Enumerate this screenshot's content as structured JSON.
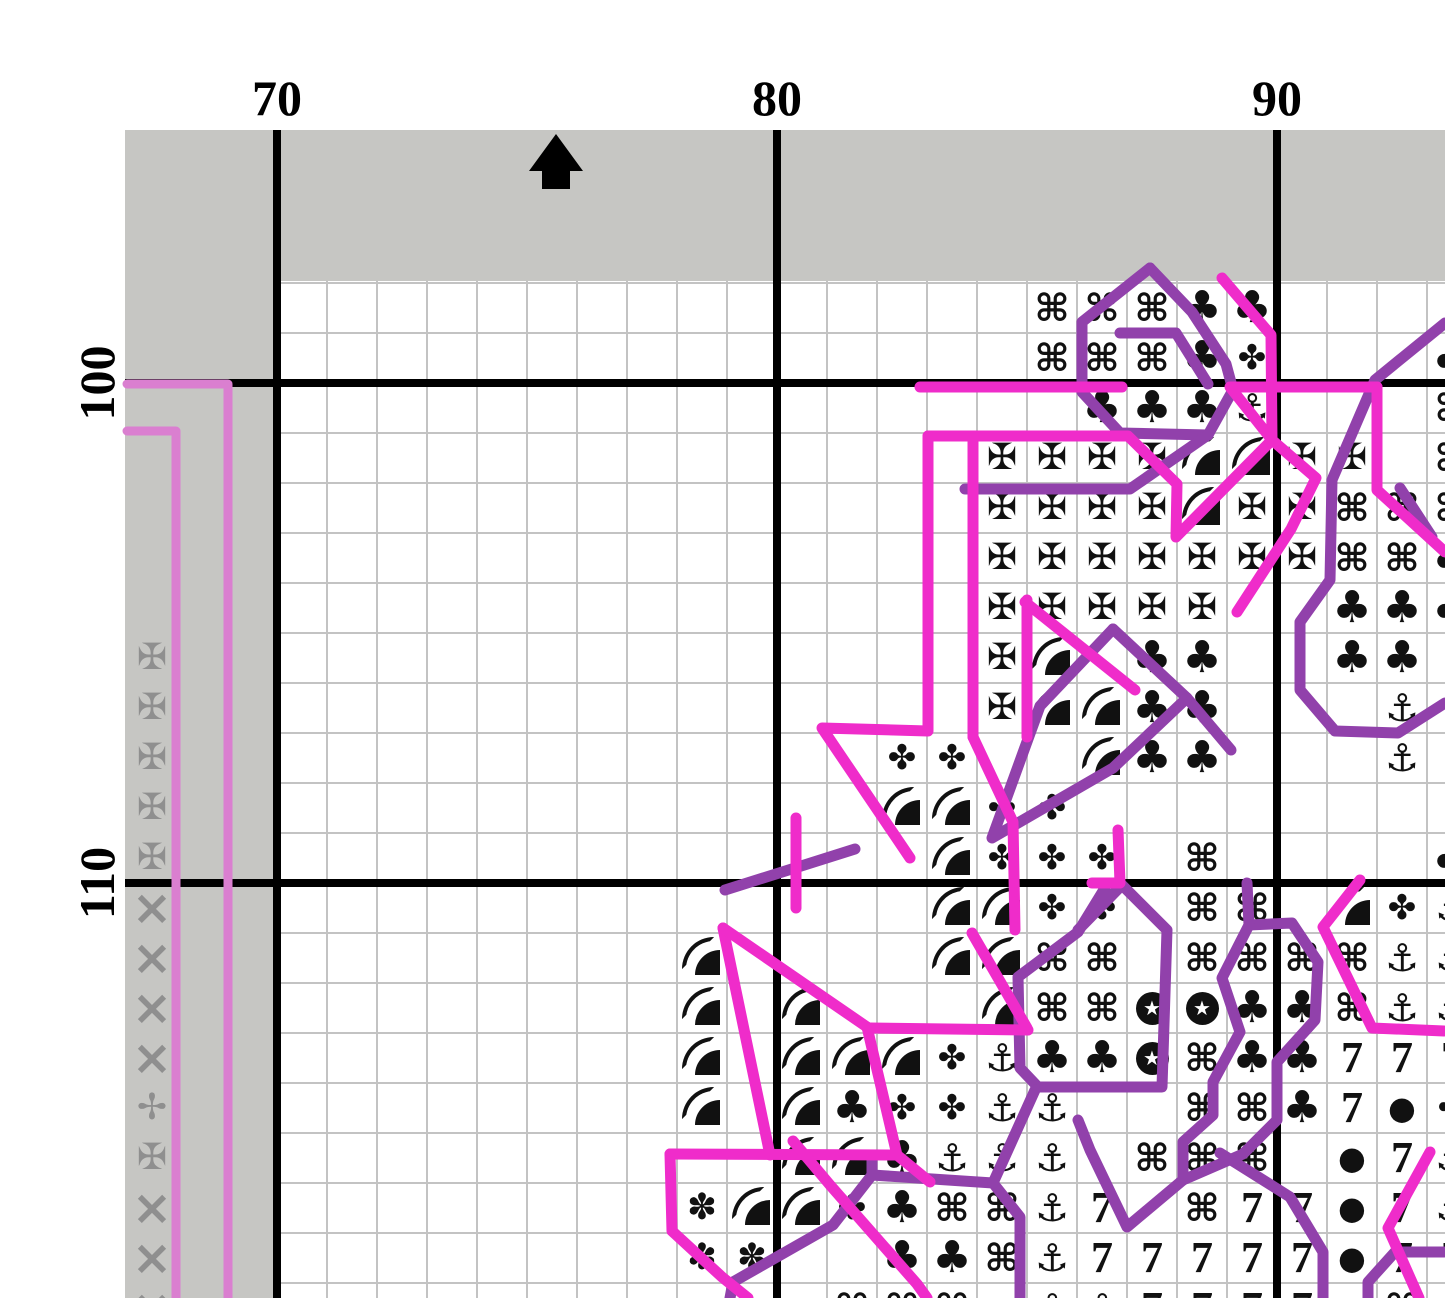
{
  "page": {
    "title": "cross-stitch-pattern-page",
    "colors": {
      "magenta_backstitch": "#ef2cca",
      "purple_backstitch": "#9141ab",
      "orchid_pageline": "#da7fd0",
      "margin_gray": "#c6c6c3",
      "minor_grid": "#c3c3c3",
      "major_grid": "#000000",
      "symbol_black": "#111111",
      "symbol_gray": "#8f8f8f",
      "paper": "#ffffff"
    }
  },
  "rulers": {
    "col_labels": [
      {
        "text": "70",
        "x": 277
      },
      {
        "text": "80",
        "x": 777
      },
      {
        "text": "90",
        "x": 1277
      }
    ],
    "row_labels": [
      {
        "text": "100",
        "y": 383
      },
      {
        "text": "110",
        "y": 883
      }
    ]
  },
  "center_arrow": {
    "tip_x": 556,
    "tip_y": 134
  },
  "legend": {
    "cmd": "⌘",
    "cross": "✠",
    "club": "♣",
    "flower": "✤",
    "anchor": "⚓",
    "seven": "7",
    "dot": "●",
    "x": "×",
    "thincross": "✢",
    "dotflower": "✽",
    "quarter": "(shape: quarter disc with arc)",
    "starcircle": "(shape: white star in black circle)"
  },
  "cells": [
    [
      85,
      98,
      "cmd"
    ],
    [
      86,
      98,
      "cmd"
    ],
    [
      87,
      98,
      "cmd"
    ],
    [
      88,
      98,
      "club"
    ],
    [
      89,
      98,
      "club"
    ],
    [
      85,
      99,
      "cmd"
    ],
    [
      86,
      99,
      "cmd"
    ],
    [
      87,
      99,
      "cmd"
    ],
    [
      88,
      99,
      "club"
    ],
    [
      89,
      99,
      "flower"
    ],
    [
      93,
      99,
      "club"
    ],
    [
      86,
      100,
      "club"
    ],
    [
      87,
      100,
      "club"
    ],
    [
      88,
      100,
      "club"
    ],
    [
      89,
      100,
      "anchor"
    ],
    [
      93,
      100,
      "cmd"
    ],
    [
      84,
      101,
      "cross"
    ],
    [
      85,
      101,
      "cross"
    ],
    [
      86,
      101,
      "cross"
    ],
    [
      87,
      101,
      "cross"
    ],
    [
      88,
      101,
      "quarter"
    ],
    [
      89,
      101,
      "quarter"
    ],
    [
      90,
      101,
      "cross"
    ],
    [
      91,
      101,
      "cross"
    ],
    [
      93,
      101,
      "cmd"
    ],
    [
      84,
      102,
      "cross"
    ],
    [
      85,
      102,
      "cross"
    ],
    [
      86,
      102,
      "cross"
    ],
    [
      87,
      102,
      "cross"
    ],
    [
      88,
      102,
      "quarter"
    ],
    [
      89,
      102,
      "cross"
    ],
    [
      90,
      102,
      "cross"
    ],
    [
      91,
      102,
      "cmd"
    ],
    [
      92,
      102,
      "cmd"
    ],
    [
      93,
      102,
      "cmd"
    ],
    [
      84,
      103,
      "cross"
    ],
    [
      85,
      103,
      "cross"
    ],
    [
      86,
      103,
      "cross"
    ],
    [
      87,
      103,
      "cross"
    ],
    [
      88,
      103,
      "cross"
    ],
    [
      89,
      103,
      "cross"
    ],
    [
      90,
      103,
      "cross"
    ],
    [
      91,
      103,
      "cmd"
    ],
    [
      92,
      103,
      "cmd"
    ],
    [
      93,
      103,
      "club"
    ],
    [
      84,
      104,
      "cross"
    ],
    [
      85,
      104,
      "cross"
    ],
    [
      86,
      104,
      "cross"
    ],
    [
      87,
      104,
      "cross"
    ],
    [
      88,
      104,
      "cross"
    ],
    [
      91,
      104,
      "club"
    ],
    [
      92,
      104,
      "club"
    ],
    [
      93,
      104,
      "club"
    ],
    [
      84,
      105,
      "cross"
    ],
    [
      85,
      105,
      "quarter"
    ],
    [
      87,
      105,
      "club"
    ],
    [
      88,
      105,
      "club"
    ],
    [
      91,
      105,
      "club"
    ],
    [
      92,
      105,
      "club"
    ],
    [
      84,
      106,
      "cross"
    ],
    [
      85,
      106,
      "quarter"
    ],
    [
      86,
      106,
      "quarter"
    ],
    [
      87,
      106,
      "club"
    ],
    [
      88,
      106,
      "club"
    ],
    [
      92,
      106,
      "anchor"
    ],
    [
      82,
      107,
      "flower"
    ],
    [
      83,
      107,
      "flower"
    ],
    [
      86,
      107,
      "quarter"
    ],
    [
      87,
      107,
      "club"
    ],
    [
      88,
      107,
      "club"
    ],
    [
      92,
      107,
      "anchor"
    ],
    [
      82,
      108,
      "quarter"
    ],
    [
      83,
      108,
      "quarter"
    ],
    [
      84,
      108,
      "flower"
    ],
    [
      85,
      108,
      "flower"
    ],
    [
      83,
      109,
      "quarter"
    ],
    [
      84,
      109,
      "flower"
    ],
    [
      85,
      109,
      "flower"
    ],
    [
      86,
      109,
      "flower"
    ],
    [
      88,
      109,
      "cmd"
    ],
    [
      93,
      109,
      "club"
    ],
    [
      83,
      110,
      "quarter"
    ],
    [
      84,
      110,
      "quarter"
    ],
    [
      85,
      110,
      "flower"
    ],
    [
      86,
      110,
      "flower"
    ],
    [
      88,
      110,
      "cmd"
    ],
    [
      89,
      110,
      "cmd"
    ],
    [
      91,
      110,
      "quarter"
    ],
    [
      92,
      110,
      "flower"
    ],
    [
      93,
      110,
      "anchor"
    ],
    [
      78,
      111,
      "quarter"
    ],
    [
      83,
      111,
      "quarter"
    ],
    [
      84,
      111,
      "quarter"
    ],
    [
      85,
      111,
      "cmd"
    ],
    [
      86,
      111,
      "cmd"
    ],
    [
      88,
      111,
      "cmd"
    ],
    [
      89,
      111,
      "cmd"
    ],
    [
      90,
      111,
      "cmd"
    ],
    [
      91,
      111,
      "cmd"
    ],
    [
      92,
      111,
      "anchor"
    ],
    [
      93,
      111,
      "anchor"
    ],
    [
      78,
      112,
      "quarter"
    ],
    [
      80,
      112,
      "quarter"
    ],
    [
      84,
      112,
      "quarter"
    ],
    [
      85,
      112,
      "cmd"
    ],
    [
      86,
      112,
      "cmd"
    ],
    [
      87,
      112,
      "starcircle"
    ],
    [
      88,
      112,
      "starcircle"
    ],
    [
      89,
      112,
      "club"
    ],
    [
      90,
      112,
      "club"
    ],
    [
      91,
      112,
      "cmd"
    ],
    [
      92,
      112,
      "anchor"
    ],
    [
      93,
      112,
      "anchor"
    ],
    [
      78,
      113,
      "quarter"
    ],
    [
      80,
      113,
      "quarter"
    ],
    [
      81,
      113,
      "quarter"
    ],
    [
      82,
      113,
      "quarter"
    ],
    [
      83,
      113,
      "flower"
    ],
    [
      84,
      113,
      "anchor"
    ],
    [
      85,
      113,
      "club"
    ],
    [
      86,
      113,
      "club"
    ],
    [
      87,
      113,
      "starcircle"
    ],
    [
      88,
      113,
      "cmd"
    ],
    [
      89,
      113,
      "club"
    ],
    [
      90,
      113,
      "club"
    ],
    [
      91,
      113,
      "seven"
    ],
    [
      92,
      113,
      "seven"
    ],
    [
      93,
      113,
      "seven"
    ],
    [
      78,
      114,
      "quarter"
    ],
    [
      80,
      114,
      "quarter"
    ],
    [
      81,
      114,
      "club"
    ],
    [
      82,
      114,
      "flower"
    ],
    [
      83,
      114,
      "flower"
    ],
    [
      84,
      114,
      "anchor"
    ],
    [
      85,
      114,
      "anchor"
    ],
    [
      88,
      114,
      "cmd"
    ],
    [
      89,
      114,
      "cmd"
    ],
    [
      90,
      114,
      "club"
    ],
    [
      91,
      114,
      "seven"
    ],
    [
      92,
      114,
      "dot"
    ],
    [
      93,
      114,
      "flower"
    ],
    [
      80,
      115,
      "quarter"
    ],
    [
      81,
      115,
      "quarter"
    ],
    [
      82,
      115,
      "club"
    ],
    [
      83,
      115,
      "anchor"
    ],
    [
      84,
      115,
      "anchor"
    ],
    [
      85,
      115,
      "anchor"
    ],
    [
      87,
      115,
      "cmd"
    ],
    [
      88,
      115,
      "cmd"
    ],
    [
      89,
      115,
      "cmd"
    ],
    [
      91,
      115,
      "dot"
    ],
    [
      92,
      115,
      "seven"
    ],
    [
      93,
      115,
      "anchor"
    ],
    [
      78,
      116,
      "dotflower"
    ],
    [
      79,
      116,
      "quarter"
    ],
    [
      80,
      116,
      "quarter"
    ],
    [
      81,
      116,
      "flower"
    ],
    [
      82,
      116,
      "club"
    ],
    [
      83,
      116,
      "cmd"
    ],
    [
      84,
      116,
      "cmd"
    ],
    [
      85,
      116,
      "anchor"
    ],
    [
      86,
      116,
      "seven"
    ],
    [
      88,
      116,
      "cmd"
    ],
    [
      89,
      116,
      "seven"
    ],
    [
      90,
      116,
      "seven"
    ],
    [
      91,
      116,
      "dot"
    ],
    [
      92,
      116,
      "seven"
    ],
    [
      93,
      116,
      "anchor"
    ],
    [
      78,
      117,
      "dotflower"
    ],
    [
      79,
      117,
      "dotflower"
    ],
    [
      82,
      117,
      "club"
    ],
    [
      83,
      117,
      "club"
    ],
    [
      84,
      117,
      "cmd"
    ],
    [
      85,
      117,
      "anchor"
    ],
    [
      86,
      117,
      "seven"
    ],
    [
      87,
      117,
      "seven"
    ],
    [
      88,
      117,
      "seven"
    ],
    [
      89,
      117,
      "seven"
    ],
    [
      90,
      117,
      "seven"
    ],
    [
      91,
      117,
      "dot"
    ],
    [
      92,
      117,
      "seven"
    ],
    [
      93,
      117,
      "seven"
    ],
    [
      81,
      118,
      "cmd"
    ],
    [
      82,
      118,
      "cmd"
    ],
    [
      83,
      118,
      "cmd"
    ],
    [
      85,
      118,
      "anchor"
    ],
    [
      86,
      118,
      "anchor"
    ],
    [
      87,
      118,
      "seven"
    ],
    [
      88,
      118,
      "seven"
    ],
    [
      89,
      118,
      "seven"
    ],
    [
      90,
      118,
      "seven"
    ],
    [
      91,
      118,
      "dot"
    ],
    [
      92,
      118,
      "cmd"
    ]
  ],
  "margin_cells": [
    [
      67,
      105,
      "cross"
    ],
    [
      67,
      106,
      "cross"
    ],
    [
      67,
      107,
      "cross"
    ],
    [
      67,
      108,
      "cross"
    ],
    [
      67,
      109,
      "cross"
    ],
    [
      67,
      110,
      "x"
    ],
    [
      67,
      111,
      "x"
    ],
    [
      67,
      112,
      "x"
    ],
    [
      67,
      113,
      "x"
    ],
    [
      67,
      114,
      "thincross"
    ],
    [
      67,
      115,
      "cross"
    ],
    [
      67,
      116,
      "x"
    ],
    [
      67,
      117,
      "x"
    ],
    [
      67,
      118,
      "x"
    ]
  ],
  "backstitch": {
    "magenta": [
      [
        [
          920,
          387
        ],
        [
          1122,
          387
        ]
      ],
      [
        [
          1377,
          387
        ],
        [
          1230,
          387
        ],
        [
          1272,
          440
        ]
      ],
      [
        [
          1377,
          387
        ],
        [
          1377,
          490
        ],
        [
          1445,
          552
        ]
      ],
      [
        [
          1222,
          278
        ],
        [
          1271,
          335
        ],
        [
          1272,
          440
        ]
      ],
      [
        [
          928,
          436
        ],
        [
          1128,
          436
        ],
        [
          1177,
          484
        ],
        [
          1176,
          537
        ],
        [
          1272,
          440
        ]
      ],
      [
        [
          1272,
          440
        ],
        [
          1316,
          478
        ],
        [
          1291,
          529
        ],
        [
          1237,
          612
        ]
      ],
      [
        [
          928,
          436
        ],
        [
          928,
          731
        ],
        [
          822,
          728
        ],
        [
          910,
          858
        ]
      ],
      [
        [
          973,
          436
        ],
        [
          973,
          737
        ]
      ],
      [
        [
          1027,
          600
        ],
        [
          1027,
          737
        ]
      ],
      [
        [
          1025,
          602
        ],
        [
          1135,
          690
        ]
      ],
      [
        [
          973,
          737
        ],
        [
          1013,
          822
        ],
        [
          1015,
          930
        ]
      ],
      [
        [
          796,
          818
        ],
        [
          796,
          908
        ]
      ],
      [
        [
          972,
          933
        ],
        [
          1027,
          1028
        ]
      ],
      [
        [
          870,
          1028
        ],
        [
          1028,
          1030
        ]
      ],
      [
        [
          723,
          928
        ],
        [
          770,
          1155
        ]
      ],
      [
        [
          723,
          928
        ],
        [
          867,
          1027
        ]
      ],
      [
        [
          867,
          1027
        ],
        [
          897,
          1155
        ],
        [
          930,
          1182
        ]
      ],
      [
        [
          670,
          1154
        ],
        [
          897,
          1155
        ]
      ],
      [
        [
          670,
          1154
        ],
        [
          672,
          1231
        ],
        [
          722,
          1277
        ],
        [
          748,
          1298
        ]
      ],
      [
        [
          793,
          1141
        ],
        [
          830,
          1185
        ],
        [
          917,
          1284
        ],
        [
          927,
          1298
        ]
      ],
      [
        [
          1360,
          880
        ],
        [
          1323,
          927
        ],
        [
          1372,
          1028
        ],
        [
          1444,
          1031
        ]
      ],
      [
        [
          1430,
          1152
        ],
        [
          1388,
          1228
        ],
        [
          1419,
          1298
        ]
      ],
      [
        [
          1118,
          830
        ],
        [
          1120,
          883
        ],
        [
          1092,
          883
        ]
      ]
    ],
    "purple": [
      [
        [
          1150,
          268
        ],
        [
          1082,
          322
        ],
        [
          1082,
          392
        ],
        [
          1120,
          433
        ],
        [
          1208,
          435
        ],
        [
          1233,
          390
        ]
      ],
      [
        [
          1150,
          268
        ],
        [
          1192,
          312
        ],
        [
          1226,
          364
        ],
        [
          1233,
          390
        ]
      ],
      [
        [
          1120,
          333
        ],
        [
          1176,
          333
        ],
        [
          1208,
          384
        ]
      ],
      [
        [
          965,
          489
        ],
        [
          1130,
          489
        ],
        [
          1208,
          435
        ]
      ],
      [
        [
          1445,
          323
        ],
        [
          1375,
          380
        ],
        [
          1332,
          480
        ],
        [
          1330,
          580
        ],
        [
          1300,
          622
        ],
        [
          1300,
          690
        ],
        [
          1335,
          731
        ],
        [
          1398,
          733
        ],
        [
          1445,
          703
        ]
      ],
      [
        [
          1400,
          488
        ],
        [
          1432,
          537
        ]
      ],
      [
        [
          1113,
          629
        ],
        [
          1187,
          698
        ],
        [
          1231,
          750
        ]
      ],
      [
        [
          1113,
          629
        ],
        [
          1040,
          706
        ],
        [
          992,
          838
        ],
        [
          1113,
          768
        ],
        [
          1187,
          698
        ]
      ],
      [
        [
          1105,
          888
        ],
        [
          1078,
          932
        ],
        [
          1018,
          977
        ],
        [
          1020,
          1068
        ],
        [
          1038,
          1087
        ],
        [
          1162,
          1087
        ],
        [
          1167,
          930
        ],
        [
          1122,
          885
        ],
        [
          1078,
          930
        ]
      ],
      [
        [
          1247,
          883
        ],
        [
          1249,
          925
        ],
        [
          1292,
          923
        ],
        [
          1318,
          962
        ],
        [
          1315,
          1020
        ],
        [
          1277,
          1062
        ],
        [
          1277,
          1120
        ],
        [
          1243,
          1154
        ],
        [
          1183,
          1180
        ],
        [
          1127,
          1227
        ],
        [
          1090,
          1150
        ],
        [
          1078,
          1120
        ]
      ],
      [
        [
          1249,
          925
        ],
        [
          1222,
          978
        ],
        [
          1240,
          1032
        ],
        [
          1213,
          1082
        ],
        [
          1213,
          1115
        ],
        [
          1183,
          1142
        ],
        [
          1183,
          1180
        ]
      ],
      [
        [
          1220,
          1153
        ],
        [
          1290,
          1197
        ],
        [
          1323,
          1252
        ],
        [
          1323,
          1298
        ]
      ],
      [
        [
          733,
          1282
        ],
        [
          833,
          1225
        ],
        [
          872,
          1175
        ],
        [
          872,
          1157
        ]
      ],
      [
        [
          872,
          1175
        ],
        [
          993,
          1183
        ],
        [
          1020,
          1217
        ],
        [
          1020,
          1298
        ]
      ],
      [
        [
          993,
          1183
        ],
        [
          1035,
          1090
        ]
      ],
      [
        [
          733,
          1282
        ],
        [
          730,
          1298
        ]
      ],
      [
        [
          855,
          849
        ],
        [
          725,
          890
        ]
      ],
      [
        [
          1444,
          1252
        ],
        [
          1395,
          1252
        ],
        [
          1368,
          1282
        ],
        [
          1368,
          1298
        ]
      ]
    ],
    "orchid": [
      [
        [
          127,
          384
        ],
        [
          228,
          384
        ],
        [
          228,
          1298
        ]
      ],
      [
        [
          127,
          431
        ],
        [
          176,
          431
        ],
        [
          176,
          1298
        ]
      ]
    ]
  }
}
